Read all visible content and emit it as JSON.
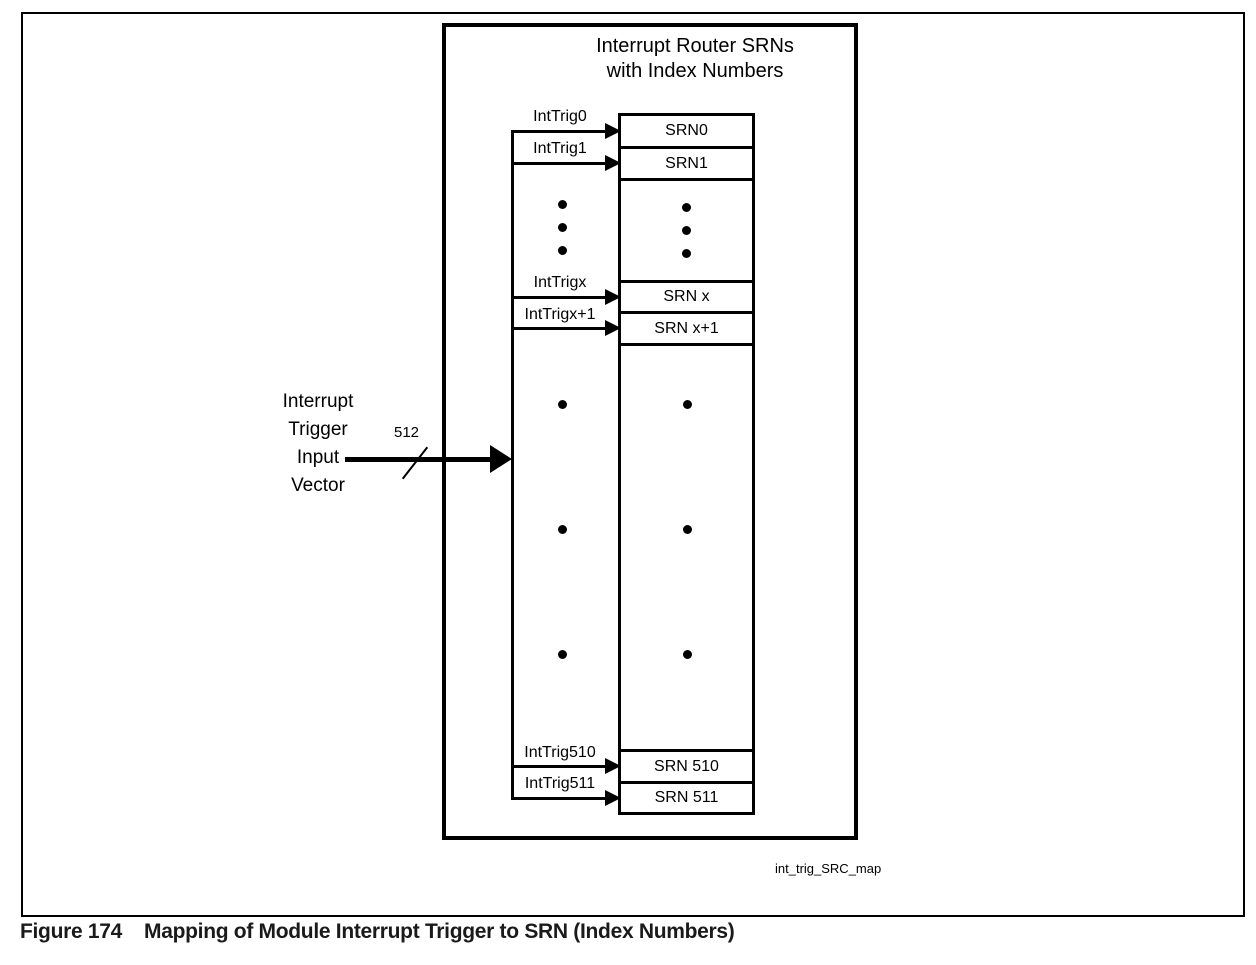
{
  "figure": {
    "caption_label": "Figure 174",
    "caption_title": "Mapping of Module Interrupt Trigger to SRN (Index Numbers)",
    "watermark": "int_trig_SRC_map"
  },
  "diagram": {
    "title_line1": "Interrupt Router SRNs",
    "title_line2": "with Index Numbers",
    "input_vector": {
      "line1": "Interrupt",
      "line2": "Trigger",
      "line3": "Input",
      "line4": "Vector",
      "bus_width": "512"
    },
    "triggers": [
      {
        "label": "IntTrig0"
      },
      {
        "label": "IntTrig1"
      },
      {
        "label": "IntTrigx"
      },
      {
        "label": "IntTrigx+1"
      },
      {
        "label": "IntTrig510"
      },
      {
        "label": "IntTrig511"
      }
    ],
    "srn_cells": [
      {
        "label": "SRN0"
      },
      {
        "label": "SRN1"
      },
      {
        "label": "SRN x"
      },
      {
        "label": "SRN x+1"
      },
      {
        "label": "SRN 510"
      },
      {
        "label": "SRN 511"
      }
    ],
    "colors": {
      "line": "#000000",
      "background": "#ffffff",
      "caption_text": "#1a1a1a"
    }
  }
}
